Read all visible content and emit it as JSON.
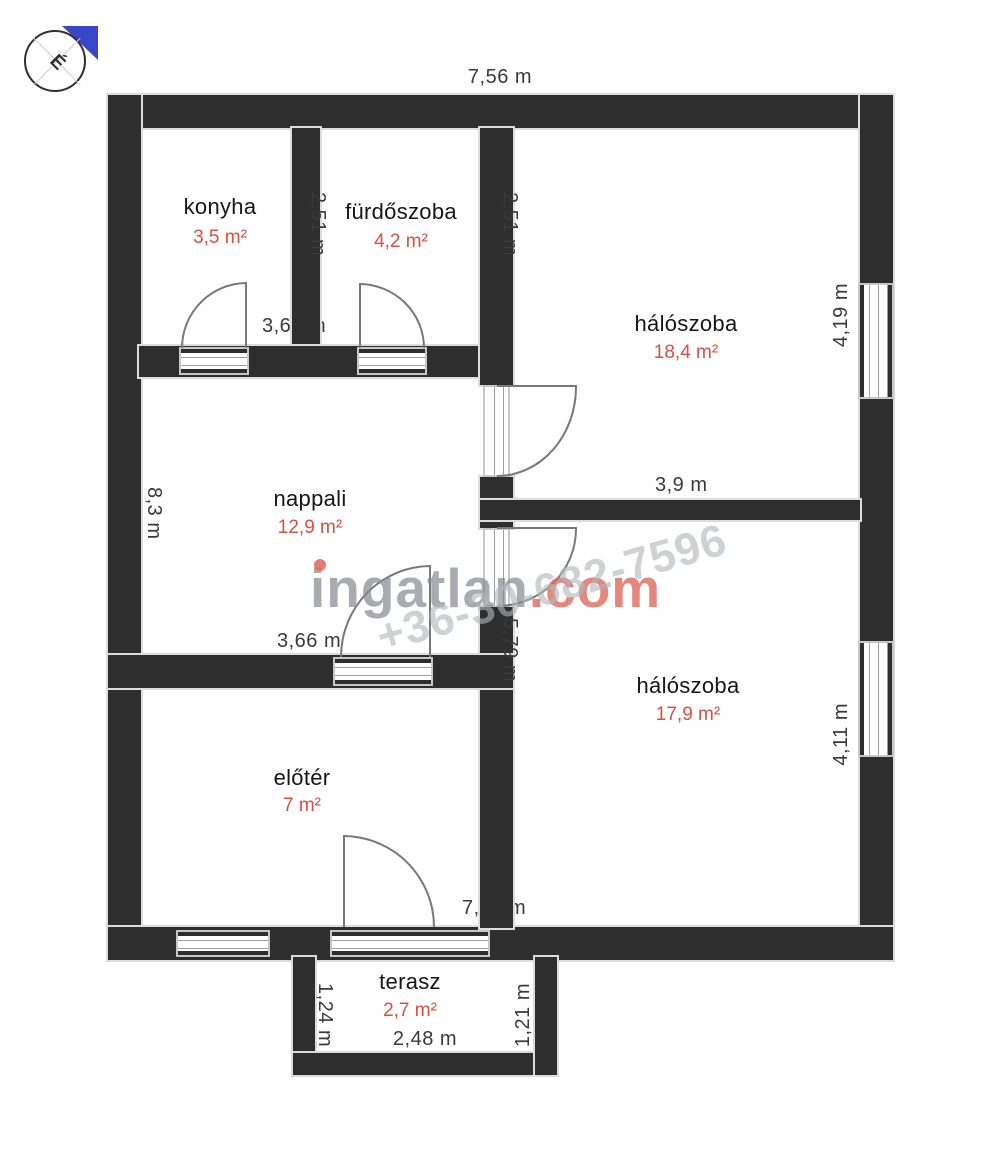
{
  "compass": {
    "north_letter": "É"
  },
  "watermark": {
    "brand": "ingatlan",
    "brand_suffix": ".com",
    "phone": "+36-30-682-7596"
  },
  "rooms": [
    {
      "name": "konyha",
      "area": "3,5 m²"
    },
    {
      "name": "fürdőszoba",
      "area": "4,2 m²"
    },
    {
      "name": "hálószoba",
      "area": "18,4 m²"
    },
    {
      "name": "nappali",
      "area": "12,9 m²"
    },
    {
      "name": "hálószoba",
      "area": "17,9 m²"
    },
    {
      "name": "előtér",
      "area": "7 m²"
    },
    {
      "name": "terasz",
      "area": "2,7 m²"
    }
  ],
  "dimensions": {
    "top_width": "7,56 m",
    "upper_left_width": "3,66 m",
    "bathroom_height": "2,51 m",
    "bedroom1_wall_height": "2,51 m",
    "bedroom1_window_length": "4,19 m",
    "bedroom1_width": "3,9 m",
    "left_side_height": "8,3 m",
    "living_width": "3,66 m",
    "hall_wall_height": "5,79 m",
    "bedroom2_window_length": "4,11 m",
    "bottom_width": "7,56 m",
    "terrace_left_height": "1,24 m",
    "terrace_right_height": "1,21 m",
    "terrace_width": "2,48 m"
  },
  "colors": {
    "wall": "#2e2e2e",
    "area_text": "#dd4e3f",
    "watermark_gray": "#868c93",
    "watermark_red": "#dd675a",
    "compass_blue": "#3a46c8"
  }
}
